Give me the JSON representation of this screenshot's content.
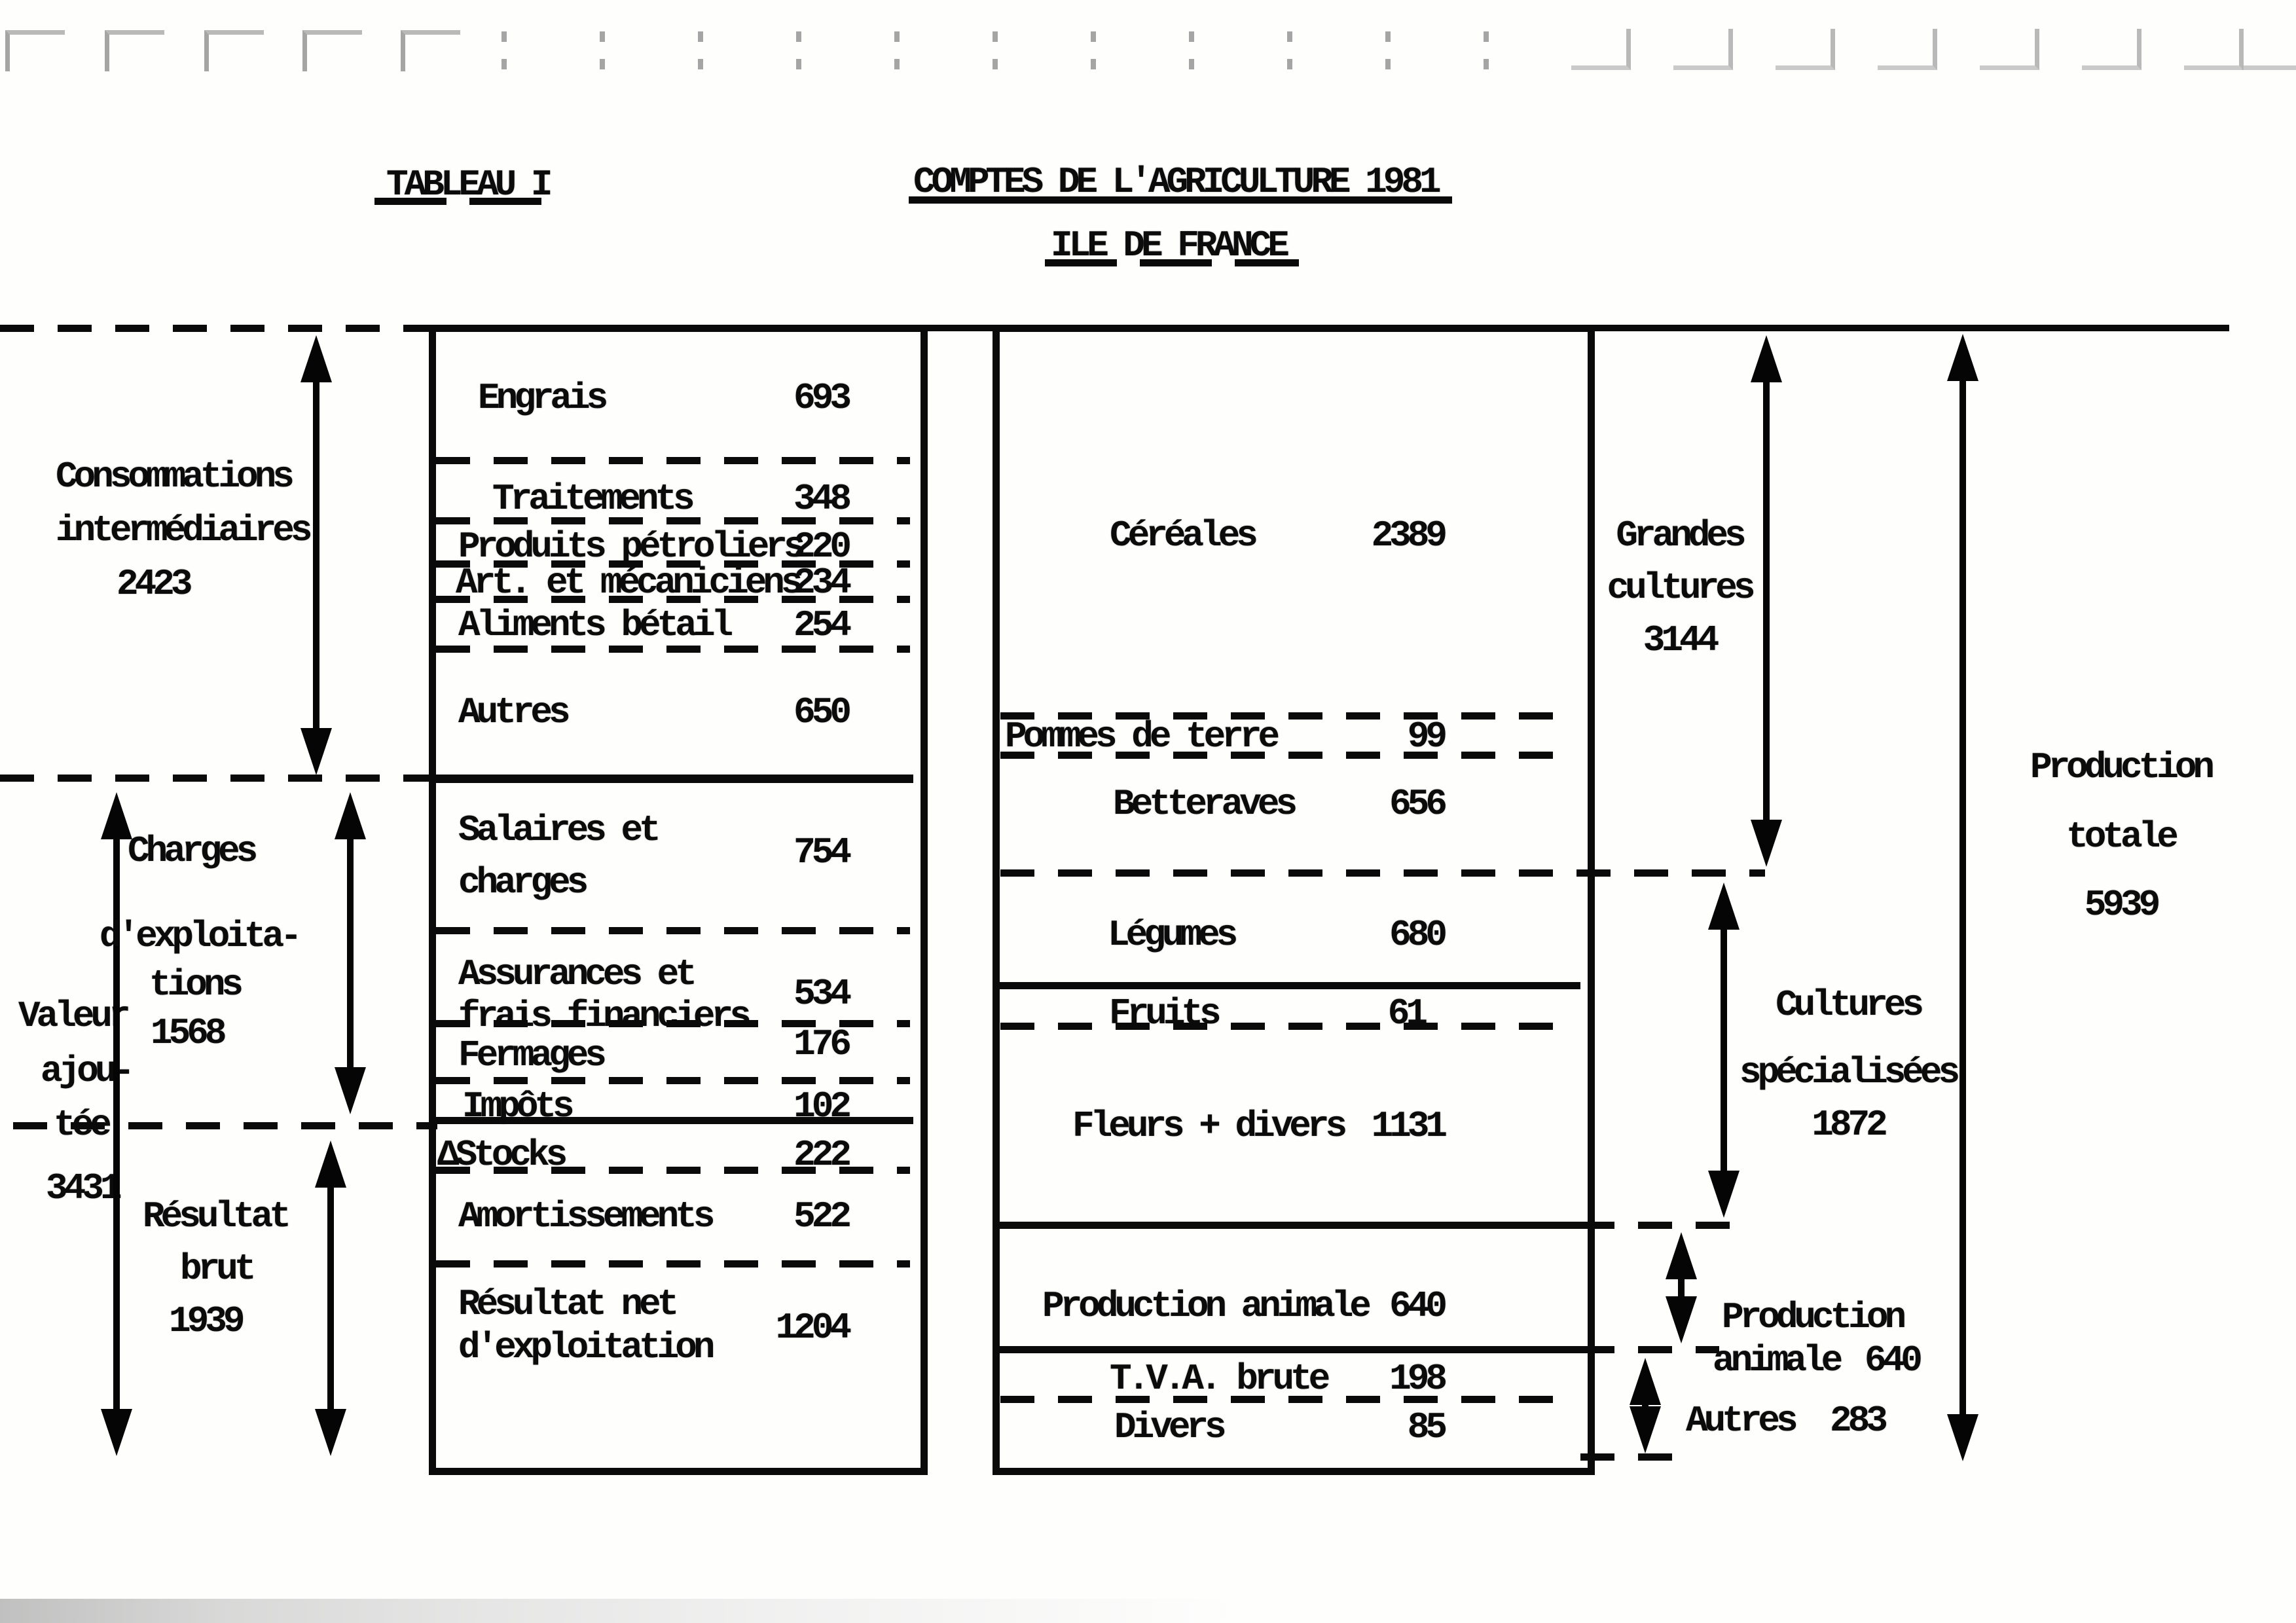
{
  "titles": {
    "tableau": "TABLEAU I",
    "main": "COMPTES DE L'AGRICULTURE 1981",
    "sub": "ILE DE FRANCE"
  },
  "left_panel": {
    "consommations": {
      "line1": "Consommations",
      "line2": "intermédiaires",
      "value": "2423"
    },
    "valeur": {
      "line1": "Valeur",
      "line2": "ajou-",
      "line3": "tée",
      "value": "3431"
    },
    "charges": {
      "line1": "Charges",
      "line2": "d'exploita-",
      "line3": "tions",
      "value": "1568"
    },
    "resultat": {
      "line1": "Résultat",
      "line2": "brut",
      "value": "1939"
    }
  },
  "cost_box": {
    "rows": [
      {
        "label": "Engrais",
        "value": "693"
      },
      {
        "label": "Traitements",
        "value": "348"
      },
      {
        "label": "Produits pétroliers",
        "value": "220"
      },
      {
        "label": "Art. et mécaniciens",
        "value": "234"
      },
      {
        "label": "Aliments bétail",
        "value": "254"
      },
      {
        "label": "Autres",
        "value": "650"
      },
      {
        "label": "Salaires et",
        "label2": "charges",
        "value": "754"
      },
      {
        "label": "Assurances et",
        "label2": "frais financiers",
        "value": "534"
      },
      {
        "label": "Fermages",
        "value": "176"
      },
      {
        "label": "Impôts",
        "value": "102"
      },
      {
        "label": "ΔStocks",
        "value": "222"
      },
      {
        "label": "Amortissements",
        "value": "522"
      },
      {
        "label": "Résultat net",
        "label2": "d'exploitation",
        "value": "1204"
      }
    ]
  },
  "production_box": {
    "rows": [
      {
        "label": "Céréales",
        "value": "2389"
      },
      {
        "label": "Pommes de terre",
        "value": "99"
      },
      {
        "label": "Betteraves",
        "value": "656"
      },
      {
        "label": "Légumes",
        "value": "680"
      },
      {
        "label": "Fruits",
        "value": "61"
      },
      {
        "label": "Fleurs + divers",
        "value": "1131"
      },
      {
        "label": "Production animale",
        "value": "640"
      },
      {
        "label": "T.V.A. brute",
        "value": "198"
      },
      {
        "label": "Divers",
        "value": "85"
      }
    ]
  },
  "right_panel": {
    "grandes": {
      "line1": "Grandes",
      "line2": "cultures",
      "value": "3144"
    },
    "specialisees": {
      "line1": "Cultures",
      "line2": "spécialisées",
      "value": "1872"
    },
    "animale": {
      "line1": "Production",
      "line2": "animale",
      "value": "640"
    },
    "autres": {
      "label": "Autres",
      "value": "283"
    },
    "totale": {
      "line1": "Production",
      "line2": "totale",
      "value": "5939"
    }
  }
}
